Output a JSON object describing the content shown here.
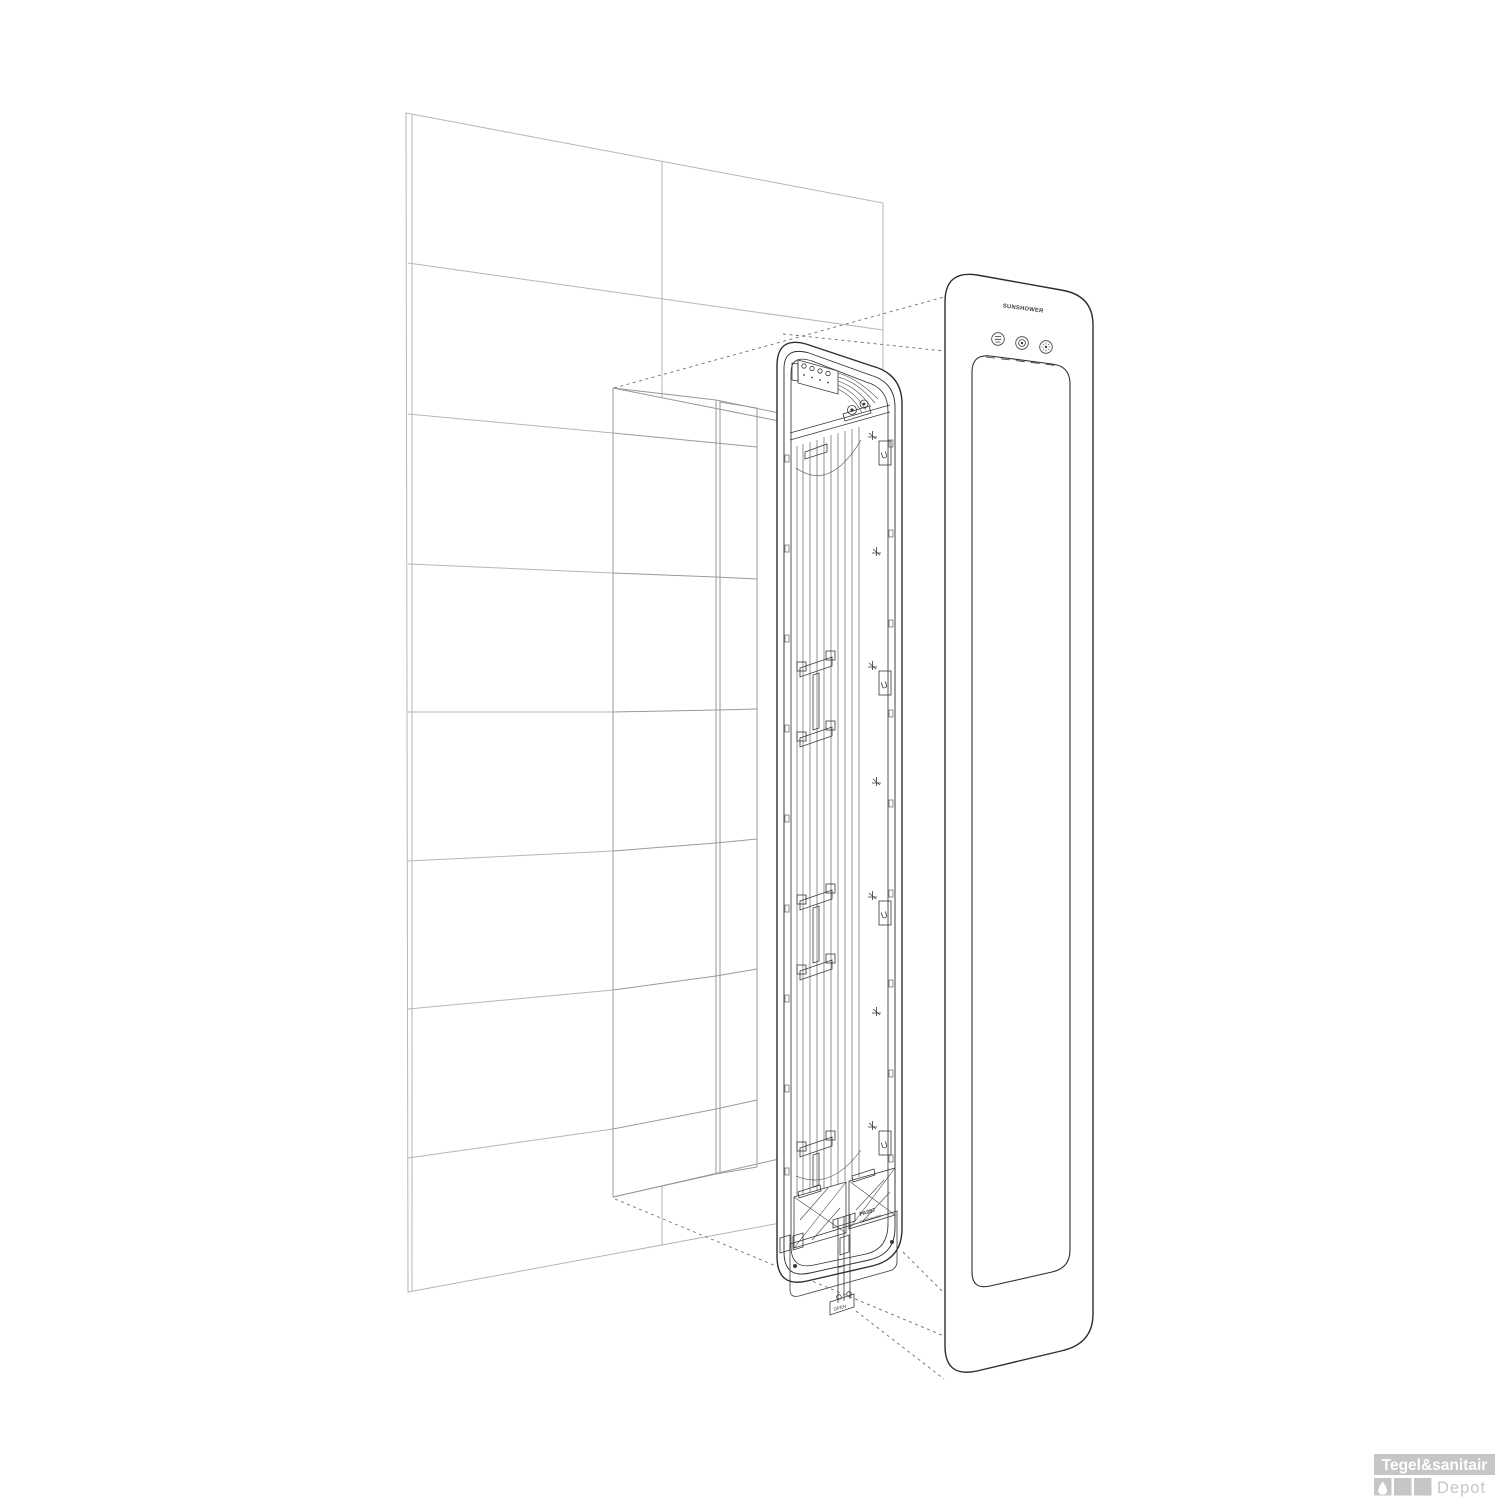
{
  "illustration": {
    "description": "Exploded installation view of a recessed wall heater: tiled wall with niche, internal mounting frame with lamps, and glass front panel",
    "brand_label": "SUNSHOWER",
    "plate_code": "PA087",
    "plate_brand": "SUNSHOWER",
    "open_tag": "OPEN",
    "clip_label": "U",
    "buttons": [
      {
        "name": "menu-button",
        "icon": "bars-icon"
      },
      {
        "name": "power-button",
        "icon": "ring-dot-icon"
      },
      {
        "name": "sun-button",
        "icon": "sun-icon"
      }
    ]
  },
  "watermark": {
    "primary": "Tegel&sanitair",
    "secondary": "Depot"
  },
  "colors": {
    "wall_line": "#b6b6b6",
    "niche_line": "#9a9a9a",
    "unit_line": "#2e2e2e",
    "projection_line": "#6e6e6e",
    "watermark_gray": "#c6c6c6",
    "background": "#ffffff"
  }
}
